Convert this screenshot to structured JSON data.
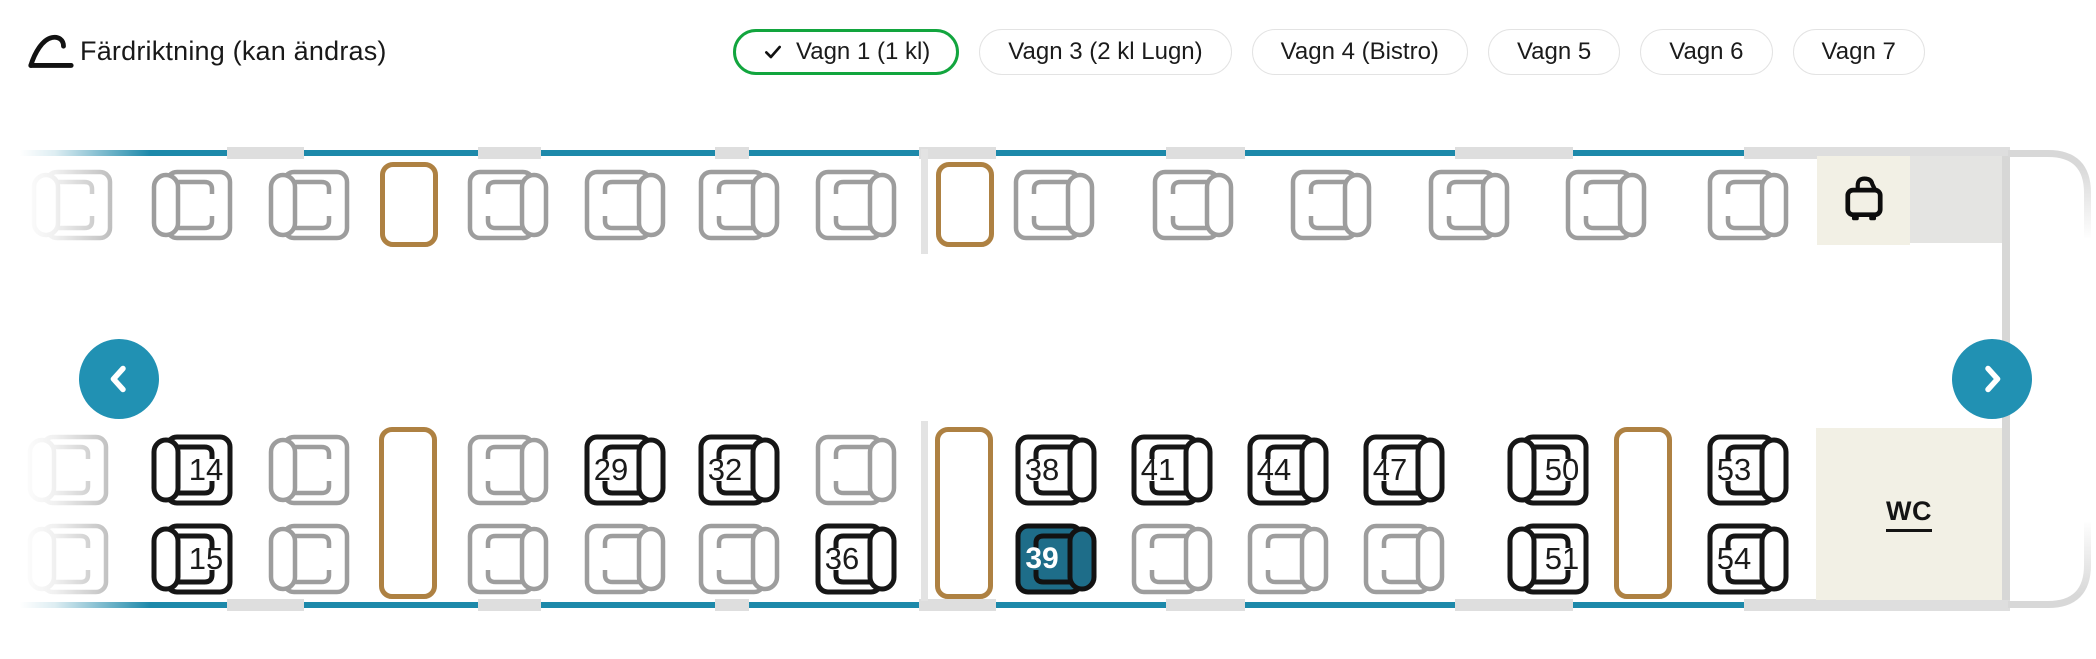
{
  "colors": {
    "accent_arrow": "#2191b3",
    "window_band": "#1d89aa",
    "selected_seat": "#1e6d89",
    "selected_tab_green": "#12a53e",
    "table_brown": "#ae8142",
    "seat_unavailable": "#9d9d9d",
    "seat_available": "#161616",
    "cream": "#f2f0e5"
  },
  "header": {
    "title": "Färdriktning (kan ändras)",
    "back_icon": "curved-back-arrow",
    "tabs": [
      {
        "label": "Vagn 1 (1 kl)",
        "selected": true
      },
      {
        "label": "Vagn 3 (2 kl Lugn)",
        "selected": false
      },
      {
        "label": "Vagn 4 (Bistro)",
        "selected": false
      },
      {
        "label": "Vagn 5",
        "selected": false
      },
      {
        "label": "Vagn 6",
        "selected": false
      },
      {
        "label": "Vagn 7",
        "selected": false
      }
    ]
  },
  "car": {
    "wc_label": "WC",
    "luggage_icon": "suitcase",
    "nav_left_icon": "chevron-left",
    "nav_right_icon": "chevron-right",
    "window_gaps": [
      [
        227,
        77
      ],
      [
        478,
        63
      ],
      [
        715,
        34
      ],
      [
        919,
        77
      ],
      [
        1166,
        79
      ],
      [
        1455,
        118
      ],
      [
        1744,
        266
      ]
    ],
    "upper_items": [
      {
        "t": "seat",
        "x": 30,
        "y": 168,
        "facing": "right",
        "state": "unavailable"
      },
      {
        "t": "seat",
        "x": 150,
        "y": 168,
        "facing": "right",
        "state": "unavailable"
      },
      {
        "t": "seat",
        "x": 267,
        "y": 168,
        "facing": "right",
        "state": "unavailable"
      },
      {
        "t": "table",
        "x": 380,
        "y": 162,
        "h": 85
      },
      {
        "t": "seat",
        "x": 466,
        "y": 168,
        "facing": "left",
        "state": "unavailable"
      },
      {
        "t": "seat",
        "x": 583,
        "y": 168,
        "facing": "left",
        "state": "unavailable"
      },
      {
        "t": "seat",
        "x": 697,
        "y": 168,
        "facing": "left",
        "state": "unavailable"
      },
      {
        "t": "seat",
        "x": 814,
        "y": 168,
        "facing": "left",
        "state": "unavailable"
      },
      {
        "t": "partition",
        "x": 921,
        "y": 149,
        "h": 105
      },
      {
        "t": "table",
        "x": 936,
        "y": 162,
        "h": 85
      },
      {
        "t": "seat",
        "x": 1012,
        "y": 168,
        "facing": "left",
        "state": "unavailable"
      },
      {
        "t": "seat",
        "x": 1151,
        "y": 168,
        "facing": "left",
        "state": "unavailable"
      },
      {
        "t": "seat",
        "x": 1289,
        "y": 168,
        "facing": "left",
        "state": "unavailable"
      },
      {
        "t": "seat",
        "x": 1427,
        "y": 168,
        "facing": "left",
        "state": "unavailable"
      },
      {
        "t": "seat",
        "x": 1564,
        "y": 168,
        "facing": "left",
        "state": "unavailable"
      },
      {
        "t": "seat",
        "x": 1706,
        "y": 168,
        "facing": "left",
        "state": "unavailable"
      }
    ],
    "lower_items": [
      {
        "t": "seat",
        "x": 26,
        "y": 433,
        "facing": "right",
        "state": "unavailable"
      },
      {
        "t": "seat",
        "x": 26,
        "y": 522,
        "facing": "right",
        "state": "unavailable"
      },
      {
        "t": "seat",
        "x": 150,
        "y": 433,
        "facing": "right",
        "state": "available",
        "num": "14"
      },
      {
        "t": "seat",
        "x": 150,
        "y": 522,
        "facing": "right",
        "state": "available",
        "num": "15"
      },
      {
        "t": "seat",
        "x": 267,
        "y": 433,
        "facing": "right",
        "state": "unavailable"
      },
      {
        "t": "seat",
        "x": 267,
        "y": 522,
        "facing": "right",
        "state": "unavailable"
      },
      {
        "t": "table",
        "x": 379,
        "y": 427,
        "h": 172
      },
      {
        "t": "seat",
        "x": 466,
        "y": 433,
        "facing": "left",
        "state": "unavailable"
      },
      {
        "t": "seat",
        "x": 466,
        "y": 522,
        "facing": "left",
        "state": "unavailable"
      },
      {
        "t": "seat",
        "x": 583,
        "y": 433,
        "facing": "left",
        "state": "available",
        "num": "29"
      },
      {
        "t": "seat",
        "x": 583,
        "y": 522,
        "facing": "left",
        "state": "unavailable"
      },
      {
        "t": "seat",
        "x": 697,
        "y": 433,
        "facing": "left",
        "state": "available",
        "num": "32"
      },
      {
        "t": "seat",
        "x": 697,
        "y": 522,
        "facing": "left",
        "state": "unavailable"
      },
      {
        "t": "seat",
        "x": 814,
        "y": 433,
        "facing": "left",
        "state": "unavailable"
      },
      {
        "t": "seat",
        "x": 814,
        "y": 522,
        "facing": "left",
        "state": "available",
        "num": "36"
      },
      {
        "t": "partition",
        "x": 921,
        "y": 421,
        "h": 180
      },
      {
        "t": "table",
        "x": 935,
        "y": 427,
        "h": 172
      },
      {
        "t": "seat",
        "x": 1014,
        "y": 433,
        "facing": "left",
        "state": "available",
        "num": "38"
      },
      {
        "t": "seat",
        "x": 1014,
        "y": 522,
        "facing": "left",
        "state": "selected",
        "num": "39"
      },
      {
        "t": "seat",
        "x": 1130,
        "y": 433,
        "facing": "left",
        "state": "available",
        "num": "41"
      },
      {
        "t": "seat",
        "x": 1130,
        "y": 522,
        "facing": "left",
        "state": "unavailable"
      },
      {
        "t": "seat",
        "x": 1246,
        "y": 433,
        "facing": "left",
        "state": "available",
        "num": "44"
      },
      {
        "t": "seat",
        "x": 1246,
        "y": 522,
        "facing": "left",
        "state": "unavailable"
      },
      {
        "t": "seat",
        "x": 1362,
        "y": 433,
        "facing": "left",
        "state": "available",
        "num": "47"
      },
      {
        "t": "seat",
        "x": 1362,
        "y": 522,
        "facing": "left",
        "state": "unavailable"
      },
      {
        "t": "seat",
        "x": 1506,
        "y": 433,
        "facing": "right",
        "state": "available",
        "num": "50"
      },
      {
        "t": "seat",
        "x": 1506,
        "y": 522,
        "facing": "right",
        "state": "available",
        "num": "51"
      },
      {
        "t": "table",
        "x": 1614,
        "y": 427,
        "h": 172
      },
      {
        "t": "seat",
        "x": 1706,
        "y": 433,
        "facing": "left",
        "state": "available",
        "num": "53"
      },
      {
        "t": "seat",
        "x": 1706,
        "y": 522,
        "facing": "left",
        "state": "available",
        "num": "54"
      }
    ]
  }
}
